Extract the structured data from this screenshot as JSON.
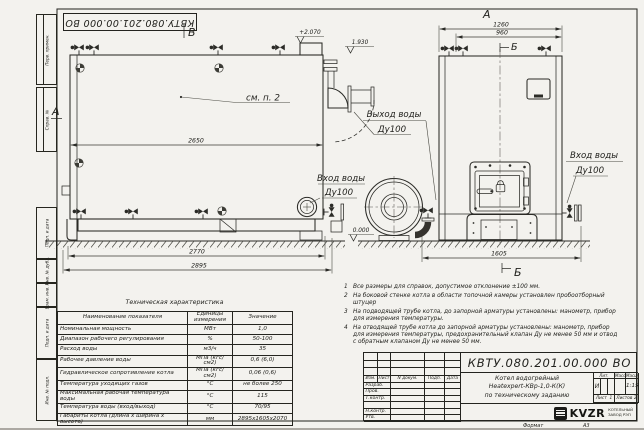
{
  "sheet": {
    "stamp": "КВТУ.080.201.00.000  ВО",
    "format_label": "Формат",
    "format_value": "А3",
    "margin_fields": [
      "Перв. примен.",
      "Справ. №",
      "Подп. и дата",
      "Инв. № дубл.",
      "Взам. инв. №",
      "Подп. и дата",
      "Инв. № подл."
    ]
  },
  "side_view": {
    "section_b": "В",
    "section_a": "А",
    "see_note": "см. п. 2",
    "elev_top": "+2.070",
    "elev_mid": "1.930",
    "elev_zero": "0.000",
    "dim_length": "2650",
    "dim_base": "2770",
    "dim_overall": "2895",
    "outlet_line1": "Выход воды",
    "outlet_line2": "Ду100",
    "inlet_line1": "Вход воды",
    "inlet_line2": "Ду100"
  },
  "front_view": {
    "title": "А",
    "dim_width": "1260",
    "dim_inner": "960",
    "dim_base": "1605",
    "section_top": "Б",
    "section_bottom": "Б",
    "inlet_line1": "Вход воды",
    "inlet_line2": "Ду100"
  },
  "notes": [
    {
      "num": "1",
      "text": "Все размеры для справок, допустимое отклонение ±100 мм."
    },
    {
      "num": "2",
      "text": "На боковой стенке котла в области топочной камеры установлен пробоотборный штуцер"
    },
    {
      "num": "3",
      "text": "На  подводящей трубе котла, до запорной арматуры установлены: манометр, прибор для измерения температуры."
    },
    {
      "num": "4",
      "text": "На отводящей трубе котла до запорной арматуры установлены: манометр, прибор для измерения температуры, предохранительный клапан Ду не менее 50 мм и отвод с обратным клапаном Ду не менее 50 мм."
    }
  ],
  "tech_table": {
    "title": "Техническая характеристика",
    "headers": [
      "Наименование показателя",
      "Единицы измерения",
      "Значение"
    ],
    "rows": [
      [
        "Номинальная мощность",
        "МВт",
        "1,0"
      ],
      [
        "Диапазон рабочего регулирования",
        "%",
        "50-100"
      ],
      [
        "Расход воды",
        "м3/ч",
        "35"
      ],
      [
        "Рабочее давление воды",
        "МПа (кгс/см2)",
        "0,6 (6,0)"
      ],
      [
        "Гидравлическое сопротивление котла",
        "МПа (кгс/см2)",
        "0,06 (0,6)"
      ],
      [
        "Температура уходящих газов",
        "°С",
        "не более 250"
      ],
      [
        "Максимальная рабочая температура воды",
        "°С",
        "115"
      ],
      [
        "Температура воды (вход/выход)",
        "°С",
        "70/95"
      ],
      [
        "Габариты котла (длина х ширина х высота)",
        "мм",
        "2895х1605х2070"
      ]
    ]
  },
  "title_block": {
    "doc_number": "КВТУ.080.201.00.000  ВО",
    "rev_headers": [
      "Изм.",
      "Лист",
      "N докум.",
      "Подп.",
      "Дата"
    ],
    "sign_labels": [
      "Разраб.",
      "Пров.",
      "Т.контр.",
      "",
      "Н.контр.",
      "Утв."
    ],
    "name_line1": "Котел водогрейный",
    "name_line2": "Heatexpert-КВр-1,0-К(К)",
    "name_line3": "по техническому заданию",
    "lit_label": "Лит.",
    "lit_value": "И",
    "mass_label": "Масса",
    "scale_label": "Масштаб",
    "scale_value": "1:15",
    "sheet_label": "Лист",
    "sheet_value": "1",
    "sheets_label": "Листов",
    "sheets_value": "2",
    "logo_text": "KVZR",
    "company_line1": "КОТЕЛЬНЫЙ",
    "company_line2": "ЗАВОД РЭП"
  }
}
